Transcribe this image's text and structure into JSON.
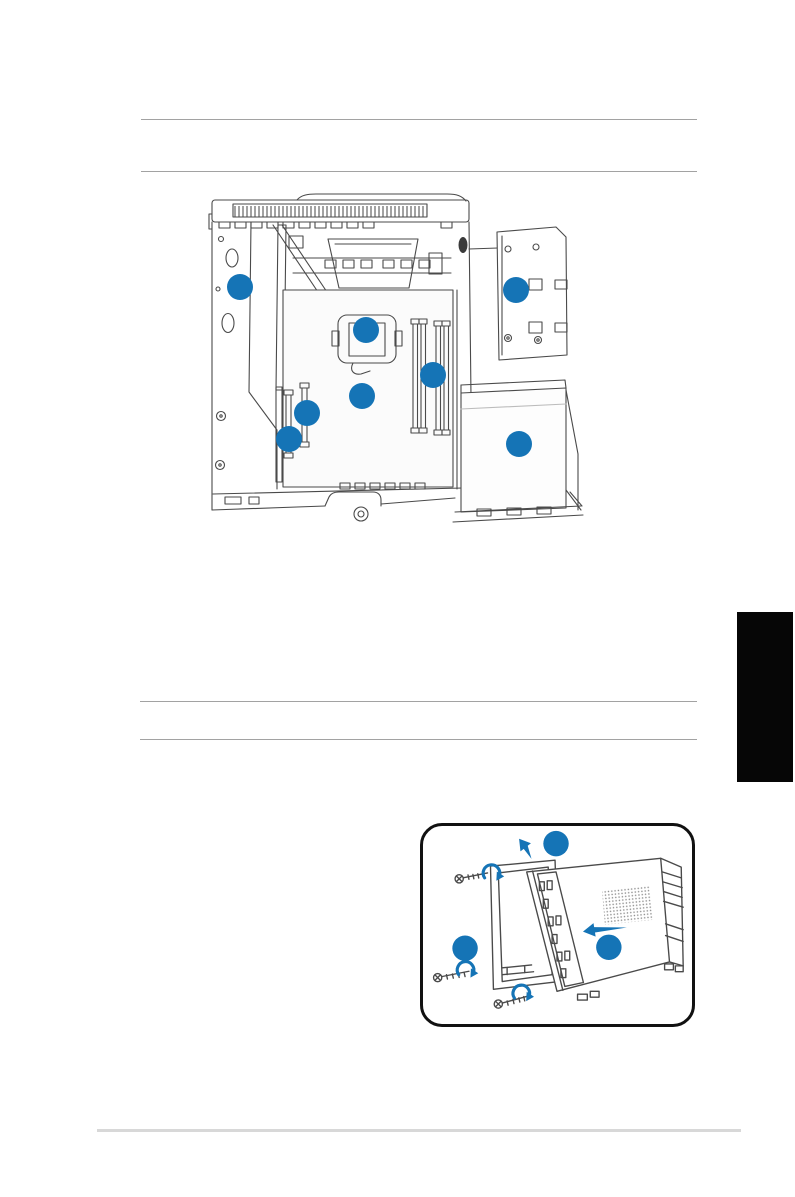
{
  "page": {
    "kind": "hardware-manual-page",
    "background": "#ffffff"
  },
  "colors": {
    "accent_blue": "#1574b6",
    "line_art": "#4a4a4a",
    "rule": "#a2a2a2",
    "footer_rule": "#d8d8d8",
    "chapter_tab": "#060606",
    "figure_border": "#111111"
  },
  "figures": {
    "case_interior": {
      "name": "desktop-case-interior-diagram",
      "callouts": [
        {
          "id": 1,
          "label": ""
        },
        {
          "id": 2,
          "label": ""
        },
        {
          "id": 3,
          "label": ""
        },
        {
          "id": 4,
          "label": ""
        },
        {
          "id": 5,
          "label": ""
        },
        {
          "id": 6,
          "label": ""
        },
        {
          "id": 7,
          "label": ""
        },
        {
          "id": 8,
          "label": ""
        }
      ]
    },
    "panel_removal": {
      "name": "side-cover-removal-diagram",
      "callouts": [
        {
          "id": 1,
          "label": ""
        },
        {
          "id": 2,
          "label": ""
        },
        {
          "id": 3,
          "label": ""
        }
      ],
      "screw_count": 3,
      "arrows": [
        "lift-up-left",
        "slide-left"
      ]
    }
  },
  "chapter_tab": {
    "label": ""
  }
}
